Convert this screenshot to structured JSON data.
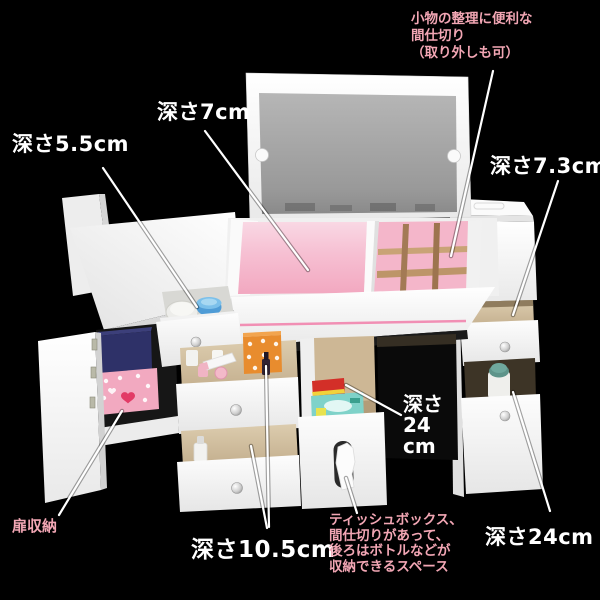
{
  "labels": {
    "partition_note": {
      "lines": [
        "小物の整理に便利な",
        "間仕切り",
        "（取り外しも可）"
      ]
    },
    "depth_7cm": {
      "text": "深さ7cm"
    },
    "depth_5_5cm": {
      "text": "深さ5.5cm"
    },
    "depth_7_3cm": {
      "text": "深さ7.3cm"
    },
    "depth_24cm_mid": {
      "lines": [
        "深さ",
        "24",
        "cm"
      ]
    },
    "depth_10_5cm": {
      "text": "深さ10.5cm"
    },
    "depth_24cm_right": {
      "text": "深さ24cm"
    },
    "door_storage": {
      "text": "扉収納"
    },
    "tissue_note": {
      "lines": [
        "ティッシュボックス、",
        "間仕切りがあって、",
        "後ろはボトルなどが",
        "収納できるスペース"
      ]
    }
  },
  "colors": {
    "background": "#000000",
    "label_white": "#ffffff",
    "label_pink": "#f2a6b4",
    "interior_pink": "#f5b3c9",
    "stripe_pink": "#f18fb4",
    "divider_wood": "#c5a07a",
    "mirror_gray": "#a2a2a2",
    "tissue_box_teal": "#7fd2c9",
    "orange_box": "#e88c2e",
    "navy_box": "#2e3168",
    "furniture_white": "#f5f5f5"
  }
}
